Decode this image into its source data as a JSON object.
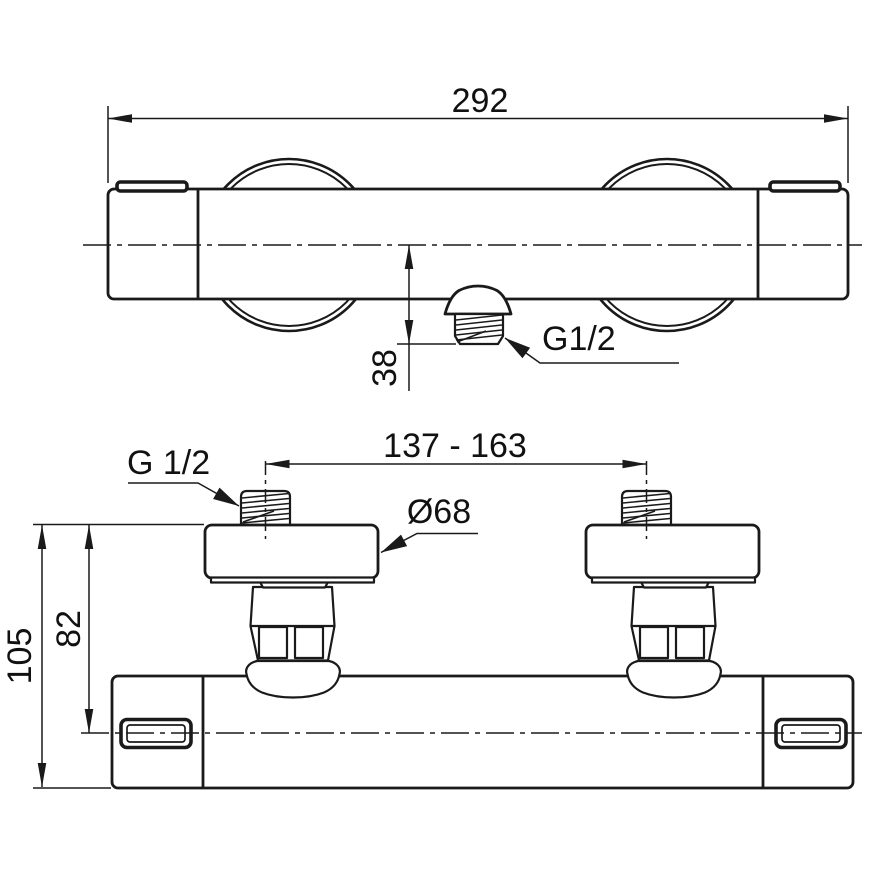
{
  "drawing_type": "technical dimensional drawing of a thermostatic shower mixer (two views)",
  "colors": {
    "background": "#ffffff",
    "line": "#1a1a1a"
  },
  "labels": {
    "top_view": {
      "overall_width": "292",
      "outlet_offset": "38",
      "outlet_thread": "G1/2"
    },
    "front_view": {
      "inlet_thread": "G 1/2",
      "inlet_spacing": "137 - 163",
      "escutcheon_diameter": "Ø68",
      "axis_height": "82",
      "overall_height": "105"
    }
  }
}
